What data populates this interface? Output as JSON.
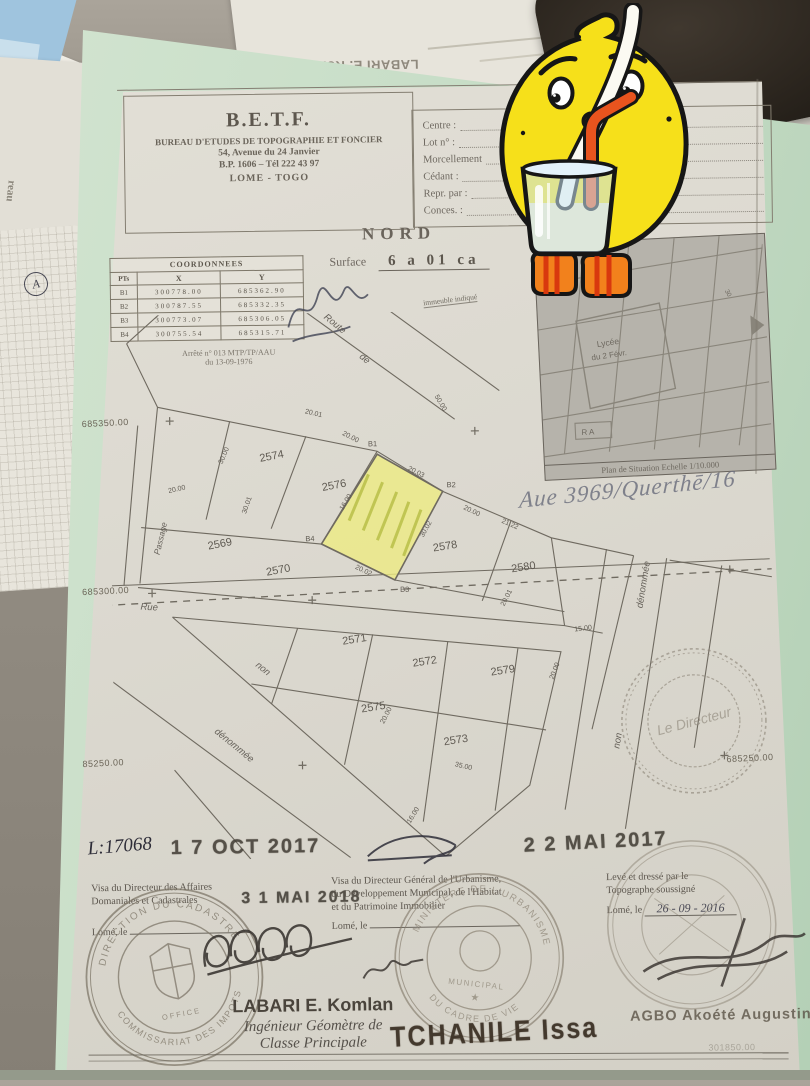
{
  "scene": {
    "colors": {
      "folder_green": "#c5dcc5",
      "highlight_yellow": "#eeeb8f",
      "stamp_ink": "#7b7365",
      "date_ink": "#433e36",
      "lemon_yellow": "#f6e01a",
      "straw_red": "#e8541e",
      "glass_blue": "#cbe6f4",
      "shoe_orange": "#f2811c"
    },
    "desk_papers": {
      "upside_down_name": "LABARI E. Komlan",
      "side_vertical_text": "reau",
      "circled_mark": "A"
    },
    "document": {
      "letterhead": {
        "acronym": "B.E.T.F.",
        "org": "BUREAU D'ETUDES DE TOPOGRAPHIE ET FONCIER",
        "address": "54, Avenue du 24 Janvier",
        "po_box": "B.P. 1606 – Tél 222 43 97",
        "city": "LOME - TOGO"
      },
      "form_fields": [
        "Centre :",
        "Lot n° :",
        "Morcellement",
        "Cédant :",
        "Repr. par :",
        "Conces. :"
      ],
      "north_label": "NORD",
      "surface_label": "Surface",
      "surface_value": "6 a 01 ca",
      "coord_table": {
        "title": "COORDONNEES",
        "col_pt": "PTs",
        "col_x": "X",
        "col_y": "Y",
        "rows": [
          [
            "B1",
            "300778.00",
            "685362.90"
          ],
          [
            "B2",
            "300787.55",
            "685332.35"
          ],
          [
            "B3",
            "300773.07",
            "685306.05"
          ],
          [
            "B4",
            "300755.54",
            "685315.71"
          ]
        ]
      },
      "arrete_line1": "Arrêté n° 013 MTP/TP/AAU",
      "arrete_line2": "du 13-09-1976",
      "situation_map": {
        "place_line1": "Lycée",
        "place_line2": "du 2 Févr.",
        "block_label": "R A",
        "road_label": "30",
        "caption": "Plan de Situation Echelle 1/10.000"
      },
      "handwritten_ref": "Aue 3969/Querthē/16",
      "plan": {
        "note_immeuble": "immeuble indiqué",
        "street_route": "Route",
        "street_route_de": "de",
        "street_rue": "Rue",
        "street_non_1": "non",
        "street_denommee_1": "dénommée",
        "street_non_2": "non",
        "street_denommee_2": "dénommée",
        "street_passage": "Passage",
        "grid_left_1": "685350.00",
        "grid_left_2": "685300.00",
        "grid_left_3": "85250.00",
        "grid_right_1": "685250.00",
        "grid_bottom_faint": "301850.00",
        "vertices": [
          "B1",
          "B2",
          "B3",
          "B4"
        ],
        "parcels": [
          "2574",
          "2576",
          "2569",
          "2570",
          "2571",
          "2572",
          "2578",
          "2580",
          "2579",
          "2575",
          "2573"
        ],
        "measurements": [
          "20.01",
          "20.00",
          "20.03",
          "30.00",
          "20.00",
          "30.01",
          "16.00",
          "20.02",
          "30.02",
          "21.22",
          "20.01",
          "15.00",
          "20.00",
          "35.00",
          "16.00",
          "50.00",
          "20.00",
          "20.00"
        ]
      },
      "dates": {
        "dossier_handwritten": "L:17068",
        "stamp_oct": "1 7 OCT 2017",
        "stamp_mai17": "2 2 MAI 2017",
        "stamp_mai18": "3 1 MAI 2018",
        "leve_date": "26 - 09 - 2016"
      },
      "stamps": {
        "left_ring_top": "DIRECTION DU CADASTRE",
        "left_ring_bottom": "COMMISSARIAT DES IMPOTS",
        "left_center": "OFFICE",
        "mid_ring_top": "MINISTERE DE L'URBANISME",
        "mid_ring_bottom": "DU CADRE DE VIE",
        "mid_inner": "MUNICIPAL",
        "mid_star": "★",
        "director_center": "Le Directeur",
        "tchanile": "TCHANILE Issa"
      },
      "footer": {
        "visa_left_1": "Visa du Directeur des Affaires",
        "visa_left_2": "Domaniales et Cadastrales",
        "visa_left_3": "Lomé, le",
        "visa_mid_1": "Visa du Directeur Général de l'Urbanisme,",
        "visa_mid_2": "du Développement Municipal, de l'Habitat",
        "visa_mid_3": "et du Patrimoine Immobilier",
        "visa_mid_4": "Lomé, le",
        "visa_right_1": "Levé et dressé par le",
        "visa_right_2": "Topographe soussigné",
        "visa_right_3": "Lomé, le",
        "name_engineer_1": "LABARI E. Komlan",
        "name_engineer_2": "Ingénieur Géomètre de",
        "name_engineer_3": "Classe Principale",
        "name_right": "AGBO Akoété Augustin"
      }
    }
  }
}
